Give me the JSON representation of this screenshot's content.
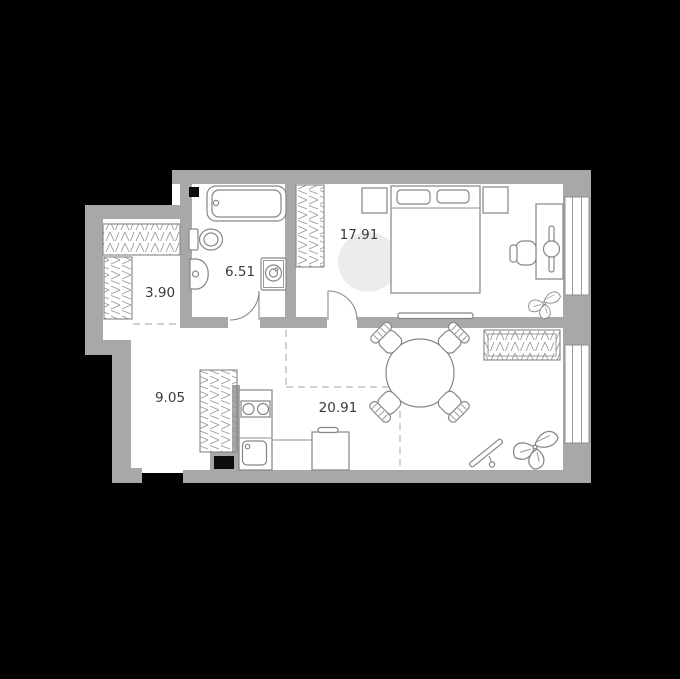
{
  "floorplan": {
    "title": "apartment-floor-plan",
    "rooms": [
      {
        "name": "wardrobe",
        "area_label": "3.90"
      },
      {
        "name": "bathroom",
        "area_label": "6.51"
      },
      {
        "name": "bedroom",
        "area_label": "17.91"
      },
      {
        "name": "hallway",
        "area_label": "9.05"
      },
      {
        "name": "living-kitchen",
        "area_label": "20.91"
      }
    ],
    "colors": {
      "background": "#000000",
      "wall": "#a8a8a8",
      "floor": "#ffffff",
      "furniture_stroke": "#868686",
      "label_text": "#3a3a3a",
      "dashed_zone_line": "#b5b5b5",
      "accent_disc": "#ececec"
    }
  }
}
